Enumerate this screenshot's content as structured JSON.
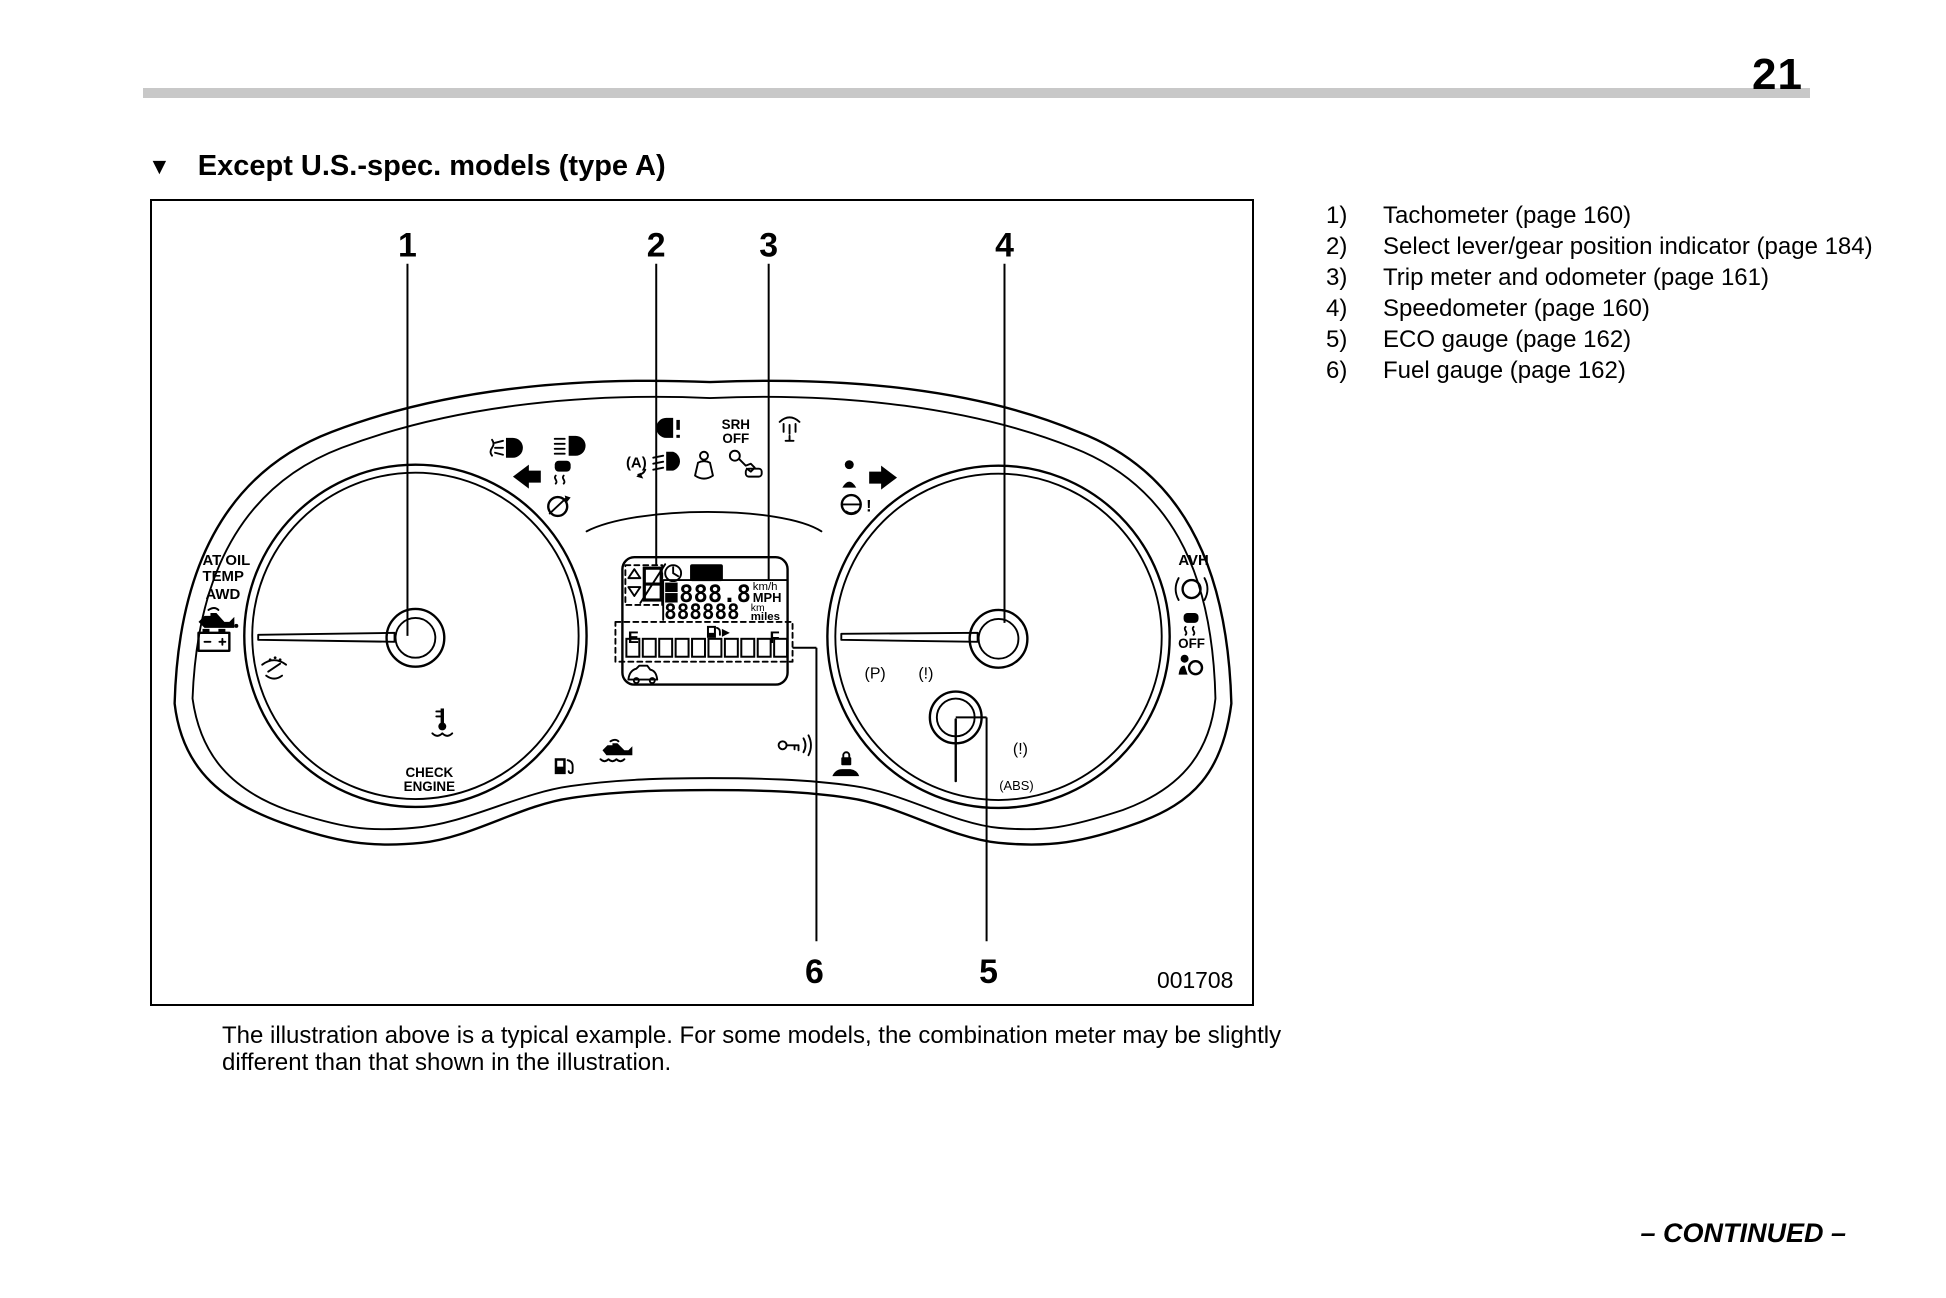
{
  "page": {
    "number": "21",
    "continued_label": "– CONTINUED –"
  },
  "heading": {
    "marker": "▼",
    "title": "Except U.S.-spec. models (type A)"
  },
  "legend": {
    "items": [
      {
        "num": "1)",
        "label": "Tachometer (page 160)"
      },
      {
        "num": "2)",
        "label": "Select lever/gear position indicator (page 184)"
      },
      {
        "num": "3)",
        "label": "Trip meter and odometer (page 161)"
      },
      {
        "num": "4)",
        "label": "Speedometer (page 160)"
      },
      {
        "num": "5)",
        "label": "ECO gauge (page 162)"
      },
      {
        "num": "6)",
        "label": "Fuel gauge (page 162)"
      }
    ]
  },
  "figure": {
    "code": "001708",
    "caption": "The illustration above is a typical example. For some models, the combination meter may be slightly different than that shown in the illustration.",
    "callouts": {
      "c1": "1",
      "c2": "2",
      "c3": "3",
      "c4": "4",
      "c5": "5",
      "c6": "6"
    },
    "cluster": {
      "at_oil": "AT OIL",
      "temp": "TEMP",
      "awd": "AWD",
      "check": "CHECK",
      "engine": "ENGINE",
      "srh": "SRH",
      "srh_off": "OFF",
      "avh": "AVH",
      "esc_off": "OFF",
      "set_label": "SET",
      "trip_a": "A",
      "trip_b": "B",
      "trip_value": "888.8",
      "odometer": "888888",
      "unit_kmh": "km/h",
      "unit_mph": "MPH",
      "unit_km": "km",
      "unit_miles": "miles",
      "fuel_empty": "E",
      "fuel_full": "F",
      "parking_brake": "(P)",
      "brake_warning": "(!)",
      "brake_warning_2": "(!)",
      "abs": "(ABS)",
      "auto_stop_start": "(A)",
      "steering_excl": "!"
    }
  },
  "colors": {
    "paper": "#ffffff",
    "ink": "#000000",
    "bar": "#c8c8c8"
  }
}
